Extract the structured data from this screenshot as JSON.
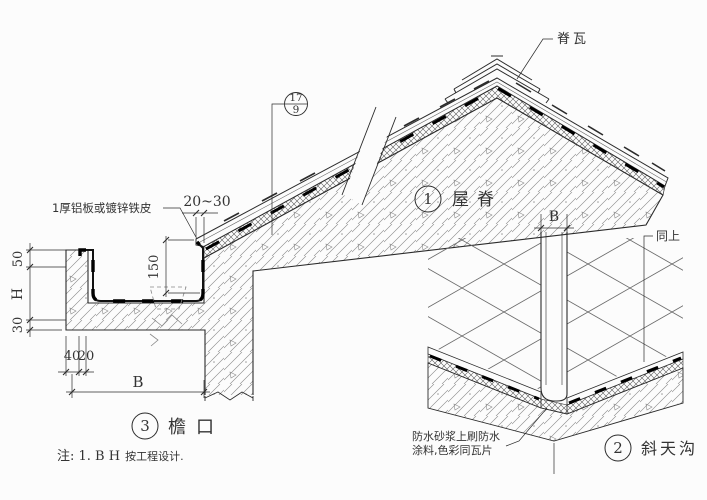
{
  "canvas": {
    "bg": "#fcfcfc",
    "line": "#2b2b2b",
    "text": "#333333"
  },
  "labels": {
    "ridge_tile": "脊瓦",
    "flashing": "1厚铝板或镀锌铁皮",
    "same_as_above": "同上",
    "waterproof_line1": "防水砂浆上刷防水",
    "waterproof_line2": "涂料,色彩同瓦片",
    "note_prefix": "注: 1. B H",
    "note_suffix": "按工程设计."
  },
  "details": [
    {
      "num": "1",
      "name": "屋脊"
    },
    {
      "num": "2",
      "name": "斜天沟"
    },
    {
      "num": "3",
      "name": "檐口"
    }
  ],
  "ref_bubble": {
    "top": "17",
    "bottom": "9"
  },
  "dims": {
    "overhang": "20~30",
    "flashing_height": "150",
    "lip": "50",
    "height": "H",
    "slab": "30",
    "w40": "40",
    "w20": "20",
    "width_eaves": "B",
    "width_valley": "B"
  }
}
